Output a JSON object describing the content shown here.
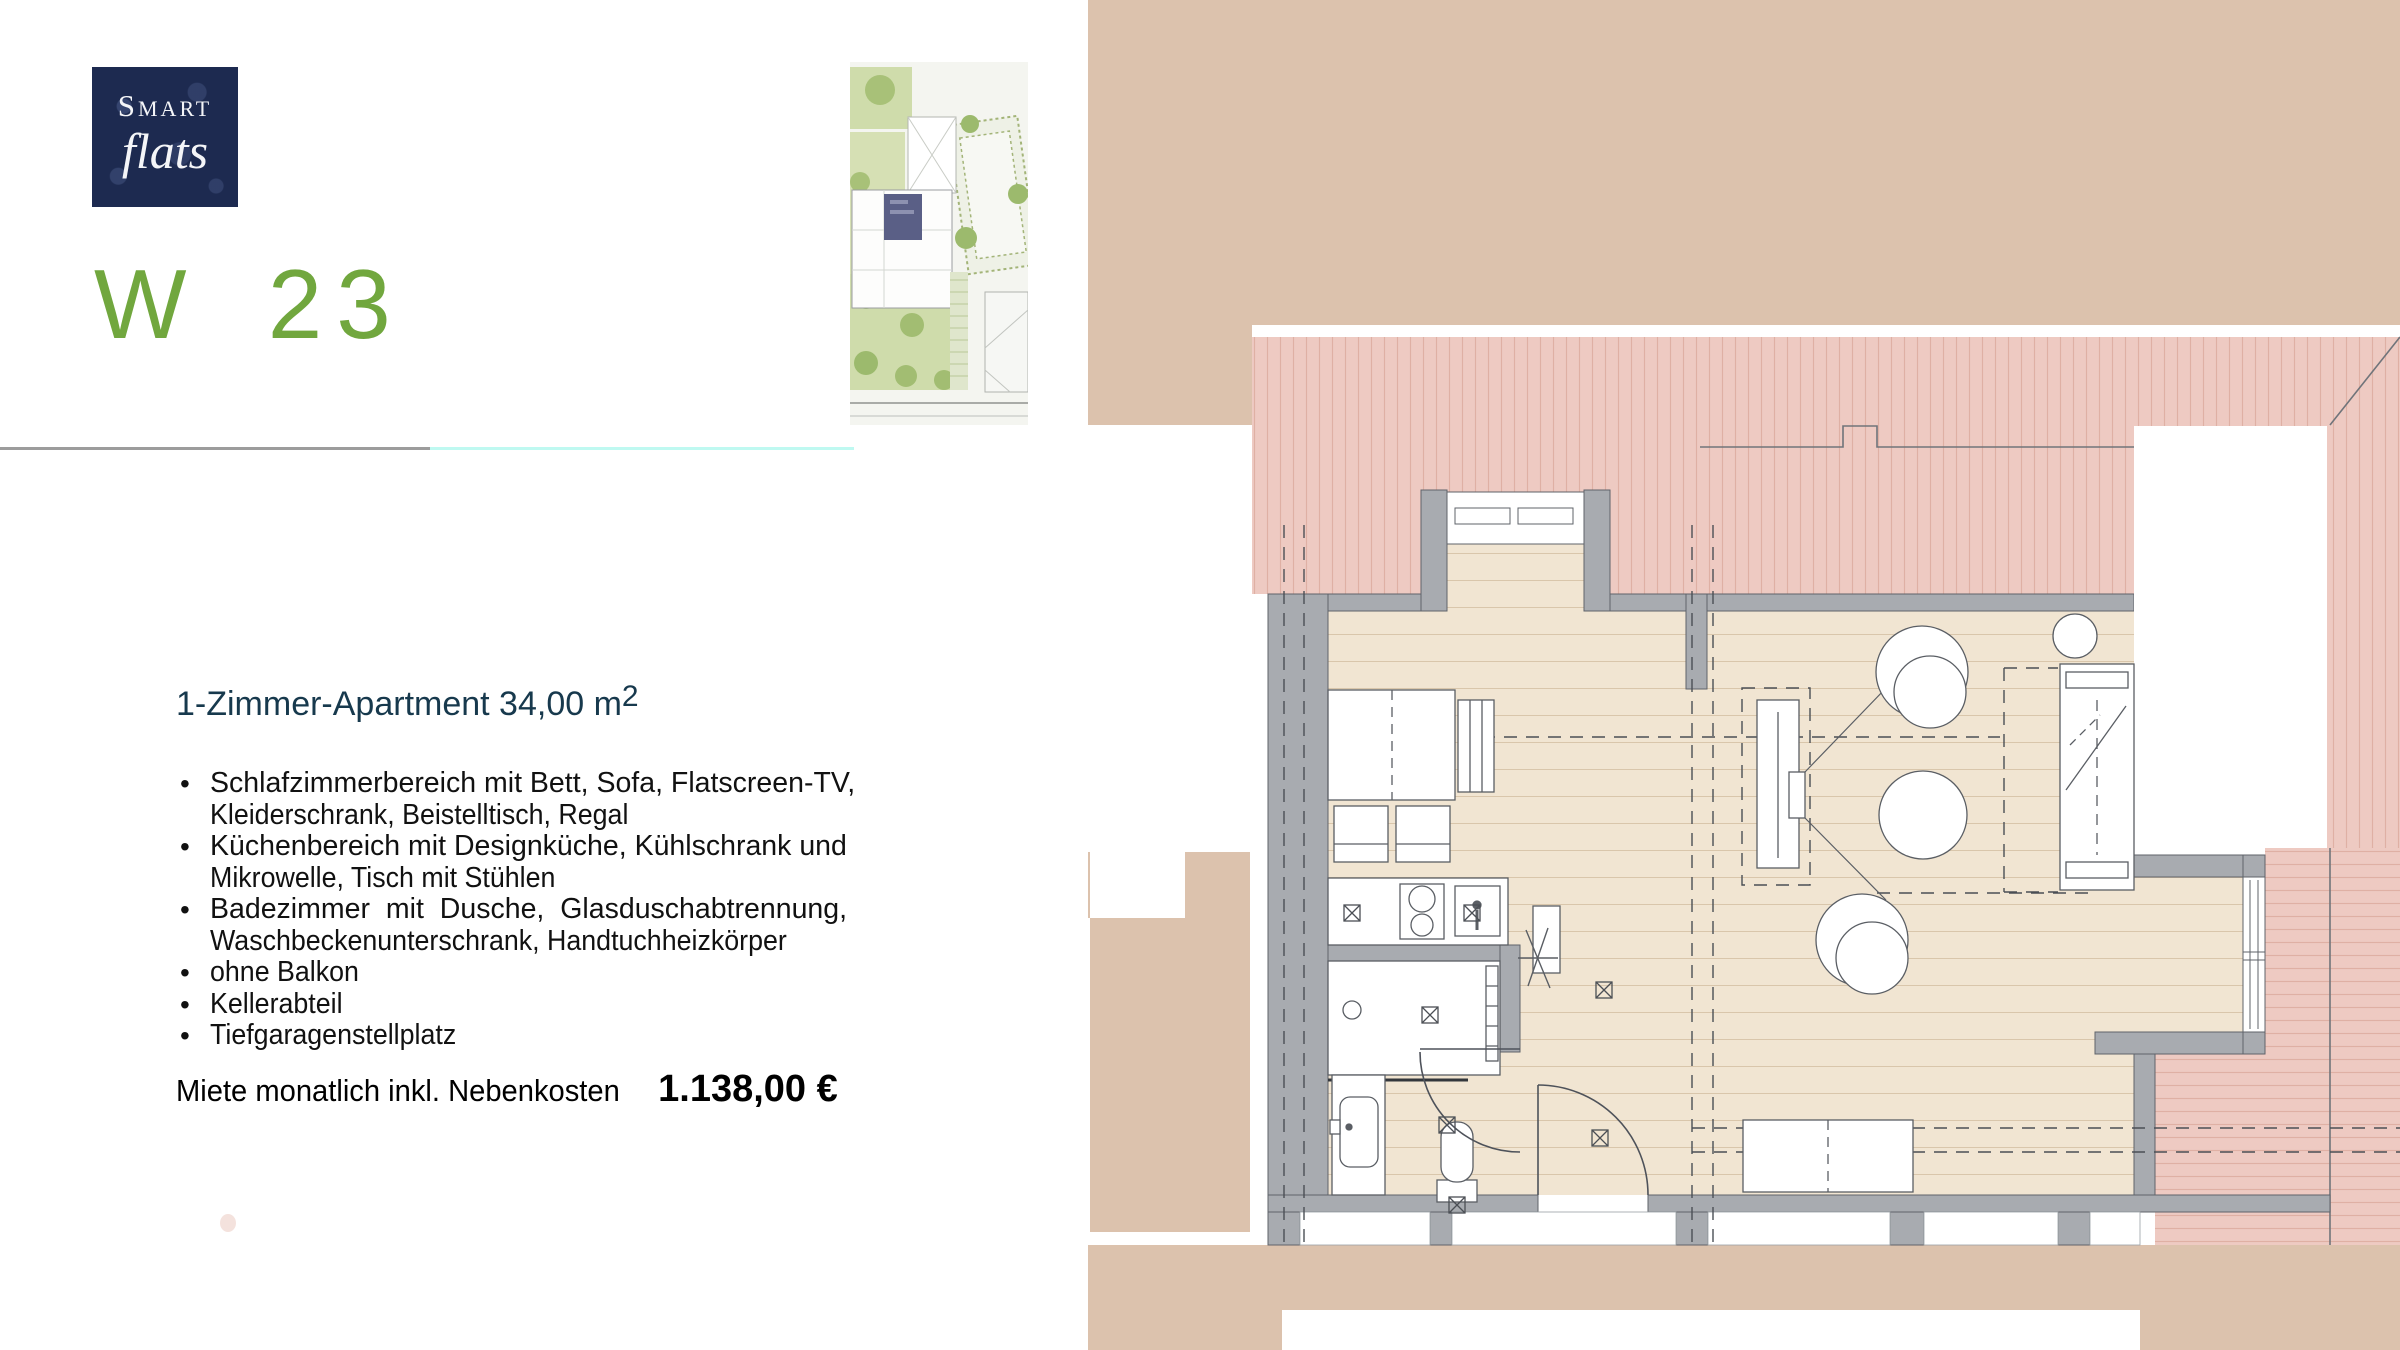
{
  "logo": {
    "line1": "Smart",
    "line2": "flats"
  },
  "unit": {
    "code": "W 23"
  },
  "details": {
    "title_text": "1-Zimmer-Apartment 34,00 m",
    "title_sup": "2",
    "bullets": [
      {
        "lines": [
          "Schlafzimmerbereich mit Bett, Sofa, Flatscreen-TV,",
          "Kleiderschrank, Beistelltisch, Regal"
        ]
      },
      {
        "lines": [
          "Küchenbereich mit Designküche, Kühlschrank und",
          "Mikrowelle, Tisch mit Stühlen"
        ]
      },
      {
        "lines": [
          "Badezimmer mit Dusche, Glasduschabtrennung,",
          "Waschbeckenunterschrank, Handtuchheizkörper"
        ]
      },
      {
        "lines": [
          "ohne Balkon"
        ]
      },
      {
        "lines": [
          "Kellerabteil"
        ]
      },
      {
        "lines": [
          "Tiefgaragenstellplatz"
        ]
      }
    ],
    "rent_label": "Miete monatlich inkl. Nebenkosten",
    "rent_value": "1.138,00 €"
  },
  "images": {
    "siteplan_label": "Lageplan mit markierter Wohnung W 23",
    "floorplan_label": "Grundriss 1-Zimmer-Apartment W 23"
  },
  "colors": {
    "accent_green": "#71a73e",
    "logo_navy": "#1d2a50",
    "title_navy": "#17394d",
    "roof_pink": "#eecac2",
    "exterior_beige": "#dcc2ad",
    "floor_wood": "#f1e5d2",
    "wall_gray": "#a8abb0",
    "divider_gray": "#9c9c9c",
    "divider_cyan": "#bff9f1",
    "siteplan_highlight": "#5a5f86"
  }
}
